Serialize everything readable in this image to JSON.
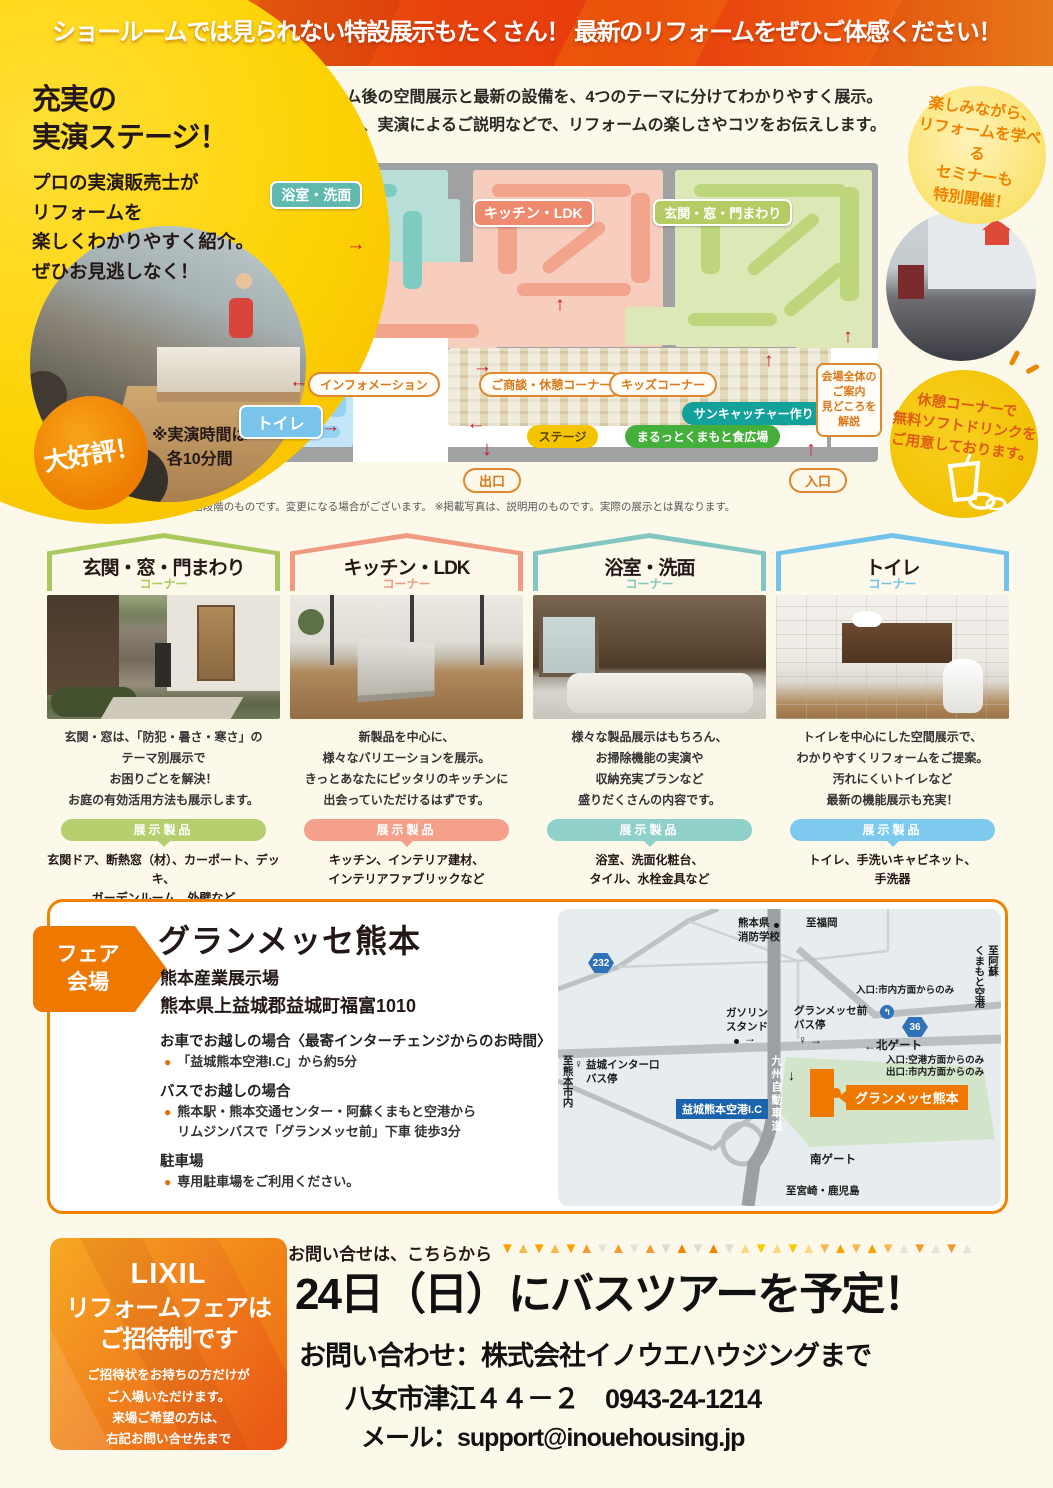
{
  "banner": {
    "text": "ショールームでは見られない特設展示もたくさん！ 最新のリフォームをぜひご体感ください！"
  },
  "stage_promo": {
    "title": "充実の\n実演ステージ！",
    "body": "プロの実演販売士が\nリフォームを\n楽しくわかりやすく紹介。\nぜひお見逃しなく！",
    "badge": "大好評！",
    "note": "※実演時間は\n各10分間"
  },
  "intro": "リフォーム後の空間展示と最新の設備を、4つのテーマに分けてわかりやすく展示。\n体感展示や、実演によるご説明などで、リフォームの楽しさやコツをお伝えします。",
  "seminar_badge": "楽しみながら、\nリフォームを学べる\nセミナーも\n特別開催！",
  "drink_badge": "休憩コーナーで\n無料ソフトドリンクを\nご用意しております。",
  "floor_map": {
    "zones": [
      {
        "label": "浴室・洗面",
        "color": "#5fb9ae"
      },
      {
        "label": "キッチン・LDK",
        "color": "#ee8a70"
      },
      {
        "label": "玄関・窓・門まわり",
        "color": "#b3cc64"
      },
      {
        "label": "トイレ",
        "color": "#78c4ea"
      }
    ],
    "facilities": [
      "インフォメーション",
      "ご商談・休憩コーナー",
      "キッズコーナー"
    ],
    "activities": [
      {
        "label": "サンキャッチャー作り",
        "color": "#12a29b"
      },
      {
        "label": "ステージ",
        "color": "#f5c400"
      },
      {
        "label": "まるっとくまもと食広場",
        "color": "#44af3b"
      }
    ],
    "exit": "出口",
    "entrance": "入口",
    "guide_note": "会場全体の\nご案内\n見どころを\n解説"
  },
  "disclaimer": "※レイアウト図・展示内容は企画段階のものです。変更になる場合がございます。 ※掲載写真は、説明用のものです。実際の展示とは異なります。",
  "corners": [
    {
      "title": "玄関・窓・門まわり",
      "subtitle": "コーナー",
      "description": "玄関・窓は、「防犯・暑さ・寒さ」の\nテーマ別展示で\nお困りごとを解決！\nお庭の有効活用方法も展示します。",
      "products_label": "展示製品",
      "products": "玄関ドア、断熱窓（材）、カーポート、デッキ、\nガーデンルーム、外壁など",
      "accent": "#a9c95e"
    },
    {
      "title": "キッチン・LDK",
      "subtitle": "コーナー",
      "description": "新製品を中心に、\n様々なバリエーションを展示。\nきっとあなたにピッタリのキッチンに\n出会っていただけるはずです。",
      "products_label": "展示製品",
      "products": "キッチン、インテリア建材、\nインテリアファブリックなど",
      "accent": "#f19a82"
    },
    {
      "title": "浴室・洗面",
      "subtitle": "コーナー",
      "description": "様々な製品展示はもちろん、\nお掃除機能の実演や\n収納充実プランなど\n盛りだくさんの内容です。",
      "products_label": "展示製品",
      "products": "浴室、洗面化粧台、\nタイル、水栓金具など",
      "accent": "#82c7bf"
    },
    {
      "title": "トイレ",
      "subtitle": "コーナー",
      "description": "トイレを中心にした空間展示で、\nわかりやすくリフォームをご提案。\n汚れにくいトイレなど\n最新の機能展示も充実！",
      "products_label": "展示製品",
      "products": "トイレ、手洗いキャビネット、\n手洗器",
      "accent": "#72c2ea"
    }
  ],
  "venue": {
    "badge": "フェア\n会場",
    "name": "グランメッセ熊本",
    "hall": "熊本産業展示場",
    "address": "熊本県上益城郡益城町福富1010",
    "access": {
      "car_heading": "お車でお越しの場合〈最寄インターチェンジからのお時間〉",
      "car_item": "「益城熊本空港I.C」から約5分",
      "bus_heading": "バスでお越しの場合",
      "bus_item": "熊本駅・熊本交通センター・阿蘇くまもと空港から\nリムジンバスで「グランメッセ前」下車 徒歩3分",
      "parking_heading": "駐車場",
      "parking_item": "専用駐車場をご利用ください。"
    },
    "map": {
      "fire_school": "熊本県\n消防学校",
      "to_fukuoka": "至福岡",
      "route_232": "232",
      "route_36": "36",
      "gas_station": "ガソリン\nスタンド",
      "granmesse_bus_stop": "グランメッセ前\nバス停",
      "entry_city_note": "入口:市内方面からのみ",
      "north_gate": "北ゲート",
      "north_gate_note": "入口:空港方面からのみ\n出口:市内方面からのみ",
      "to_aso_airport": "至阿蘇\nくまもと空港",
      "to_kumamoto_city": "至熊本市内",
      "mashiki_bus_stop": "益城インター口\nバス停",
      "ic_label": "益城熊本空港I.C",
      "expressway": "九州自動車道",
      "granmesse": "グランメッセ熊本",
      "south_gate": "南ゲート",
      "to_miyazaki": "至宮崎・鹿児島"
    }
  },
  "invitation": {
    "brand": "LIXIL",
    "title": "リフォームフェアは\nご招待制です",
    "body": "ご招待状をお持ちの方だけが\nご入場いただけます。\n来場ご希望の方は、\n右記お問い合せ先まで"
  },
  "contact": {
    "lead": "お問い合せは、こちらから",
    "headline": "24日（日）にバスツアーを予定！",
    "line1": "お問い合わせ：株式会社イノウエハウジングまで",
    "line2": "八女市津江４４－２　0943-24-1214",
    "line3": "メール：support@inouehousing.jp"
  },
  "icons": {
    "arrow_right": "→",
    "arrow_left": "←",
    "arrow_up": "↑",
    "arrow_down": "↓",
    "bus_stop": "♀",
    "dot": "●",
    "turn_left": "↰"
  },
  "colors": {
    "accent_orange": "#ee7800",
    "banner_red": "#e8420c",
    "brand_yellow": "#fcd000",
    "map_gray": "#a0a1a3",
    "triangle_strip": [
      "#f6a200",
      "#fcc800",
      "#f08300",
      "#e3e3da",
      "#f6b94d",
      "#fcd97f",
      "#d8dcd5",
      "#ef9b30"
    ]
  }
}
